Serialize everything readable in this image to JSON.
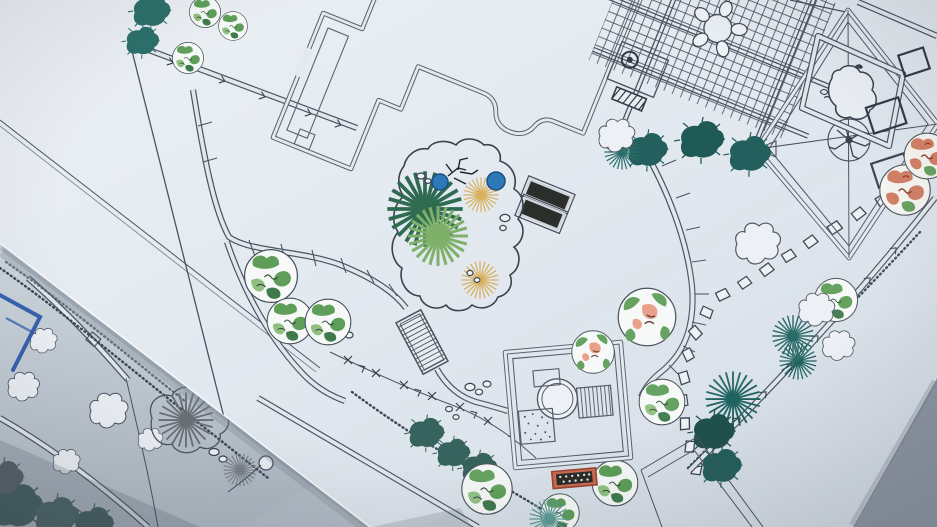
{
  "meta": {
    "type": "photograph",
    "subject": "Two landscape-architecture plan sheets photographed at an angle on a desk",
    "visible_text": "none (linework only, no legible labels)"
  },
  "sheets": [
    {
      "id": "master-plan-sheet",
      "label": "Large landscape master plan sheet (on top, tilted about 22 degrees)",
      "paper_color": "#e3e9ef"
    },
    {
      "id": "sketch-sheet",
      "label": "Concept sketch sheet underneath at lower-left (in shadow)",
      "paper_color": "#c9d2da"
    }
  ],
  "palette": {
    "ink_line": "#4a5460",
    "wall_line": "#59636e",
    "heavy_line": "#343b46",
    "tree_green": "#5e9e58",
    "tree_green_light": "#8fc07f",
    "tree_green_dark": "#3f7a4c",
    "teal_plant": "#22605d",
    "tan_plant": "#d9b25f",
    "pond_blue": "#2e78b8",
    "coral_tree": "#cf7a5e",
    "coral_dark": "#8a3a28",
    "pink_bloom": "#e89a83",
    "mat_orange": "#c96b52",
    "panel_dark": "#2c2e2b",
    "blue_marker": "#2a57ad",
    "gray_plant": "#6b7077",
    "table_surface": "#97a1ac"
  },
  "features": {
    "house": {
      "label": "House footprint with double-line walls and curved patio recess",
      "count": 1
    },
    "pergola": {
      "label": "Pergola / deck lattice with round table and five chairs",
      "count": 1
    },
    "panels": {
      "label": "Two dark rectangular panels beside the house",
      "count": 2
    },
    "planting_bed": {
      "label": "Free-form planting bed with fan palms, tan sunburst shrubs, two blue pools and boulders",
      "count": 1
    },
    "stairs": {
      "label": "Hatched garden stair ramp",
      "count": 1
    },
    "curved_paths": {
      "label": "Double-line curved garden paths with survey tick marks",
      "count": 2
    },
    "stepping_stones": {
      "label": "Stepping-stone trail of small pads",
      "count": 18
    },
    "pavilion": {
      "label": "Rotated square pavilion with round feature, board deck and gravel pad",
      "count": 1
    },
    "mat": {
      "label": "Red-orange dotted mat below pavilion",
      "count": 1
    },
    "diamond": {
      "label": "Large rotated-square canopy with corner diagonals and center tree",
      "count": 1
    },
    "rock_pond": {
      "label": "Free-form boulder pond inside tilted square enclosure",
      "count": 1
    },
    "small_squares": {
      "label": "Three small tilted square pads at right edge",
      "count": 3
    },
    "round_trees_green": {
      "label": "Round green mottled canopy trees",
      "count": 12
    },
    "flowering_trees": {
      "label": "Round trees with pink/coral bloom patches",
      "count": 2
    },
    "coral_trees": {
      "label": "Autumn coral-colored canopy trees at right edge",
      "count": 2
    },
    "teal_clumps": {
      "label": "Dark teal shrub masses and spiky sunburst plants",
      "count": 10
    },
    "cloud_shrubs": {
      "label": "Cloud-outline shrubs",
      "count": 5
    },
    "fences": {
      "label": "Boundary fence lines with arrow and X post marks",
      "count": 3
    },
    "hedges": {
      "label": "Scribbled hedge bands",
      "count": 2
    },
    "building_corner": {
      "label": "Corner of outbuilding at bottom right",
      "count": 1
    },
    "sketch_roads": {
      "label": "Curved road lines on lower sketch sheet",
      "count": 2
    },
    "sketch_blue": {
      "label": "Blue marker rectangle and blobs on lower sketch sheet",
      "count": 1
    },
    "sketch_starburst": {
      "label": "Gray starburst plants on lower sketch sheet",
      "count": 2
    },
    "sketch_clouds": {
      "label": "Cloud bushes and hedge scribble on lower sketch sheet",
      "count": 5
    }
  }
}
